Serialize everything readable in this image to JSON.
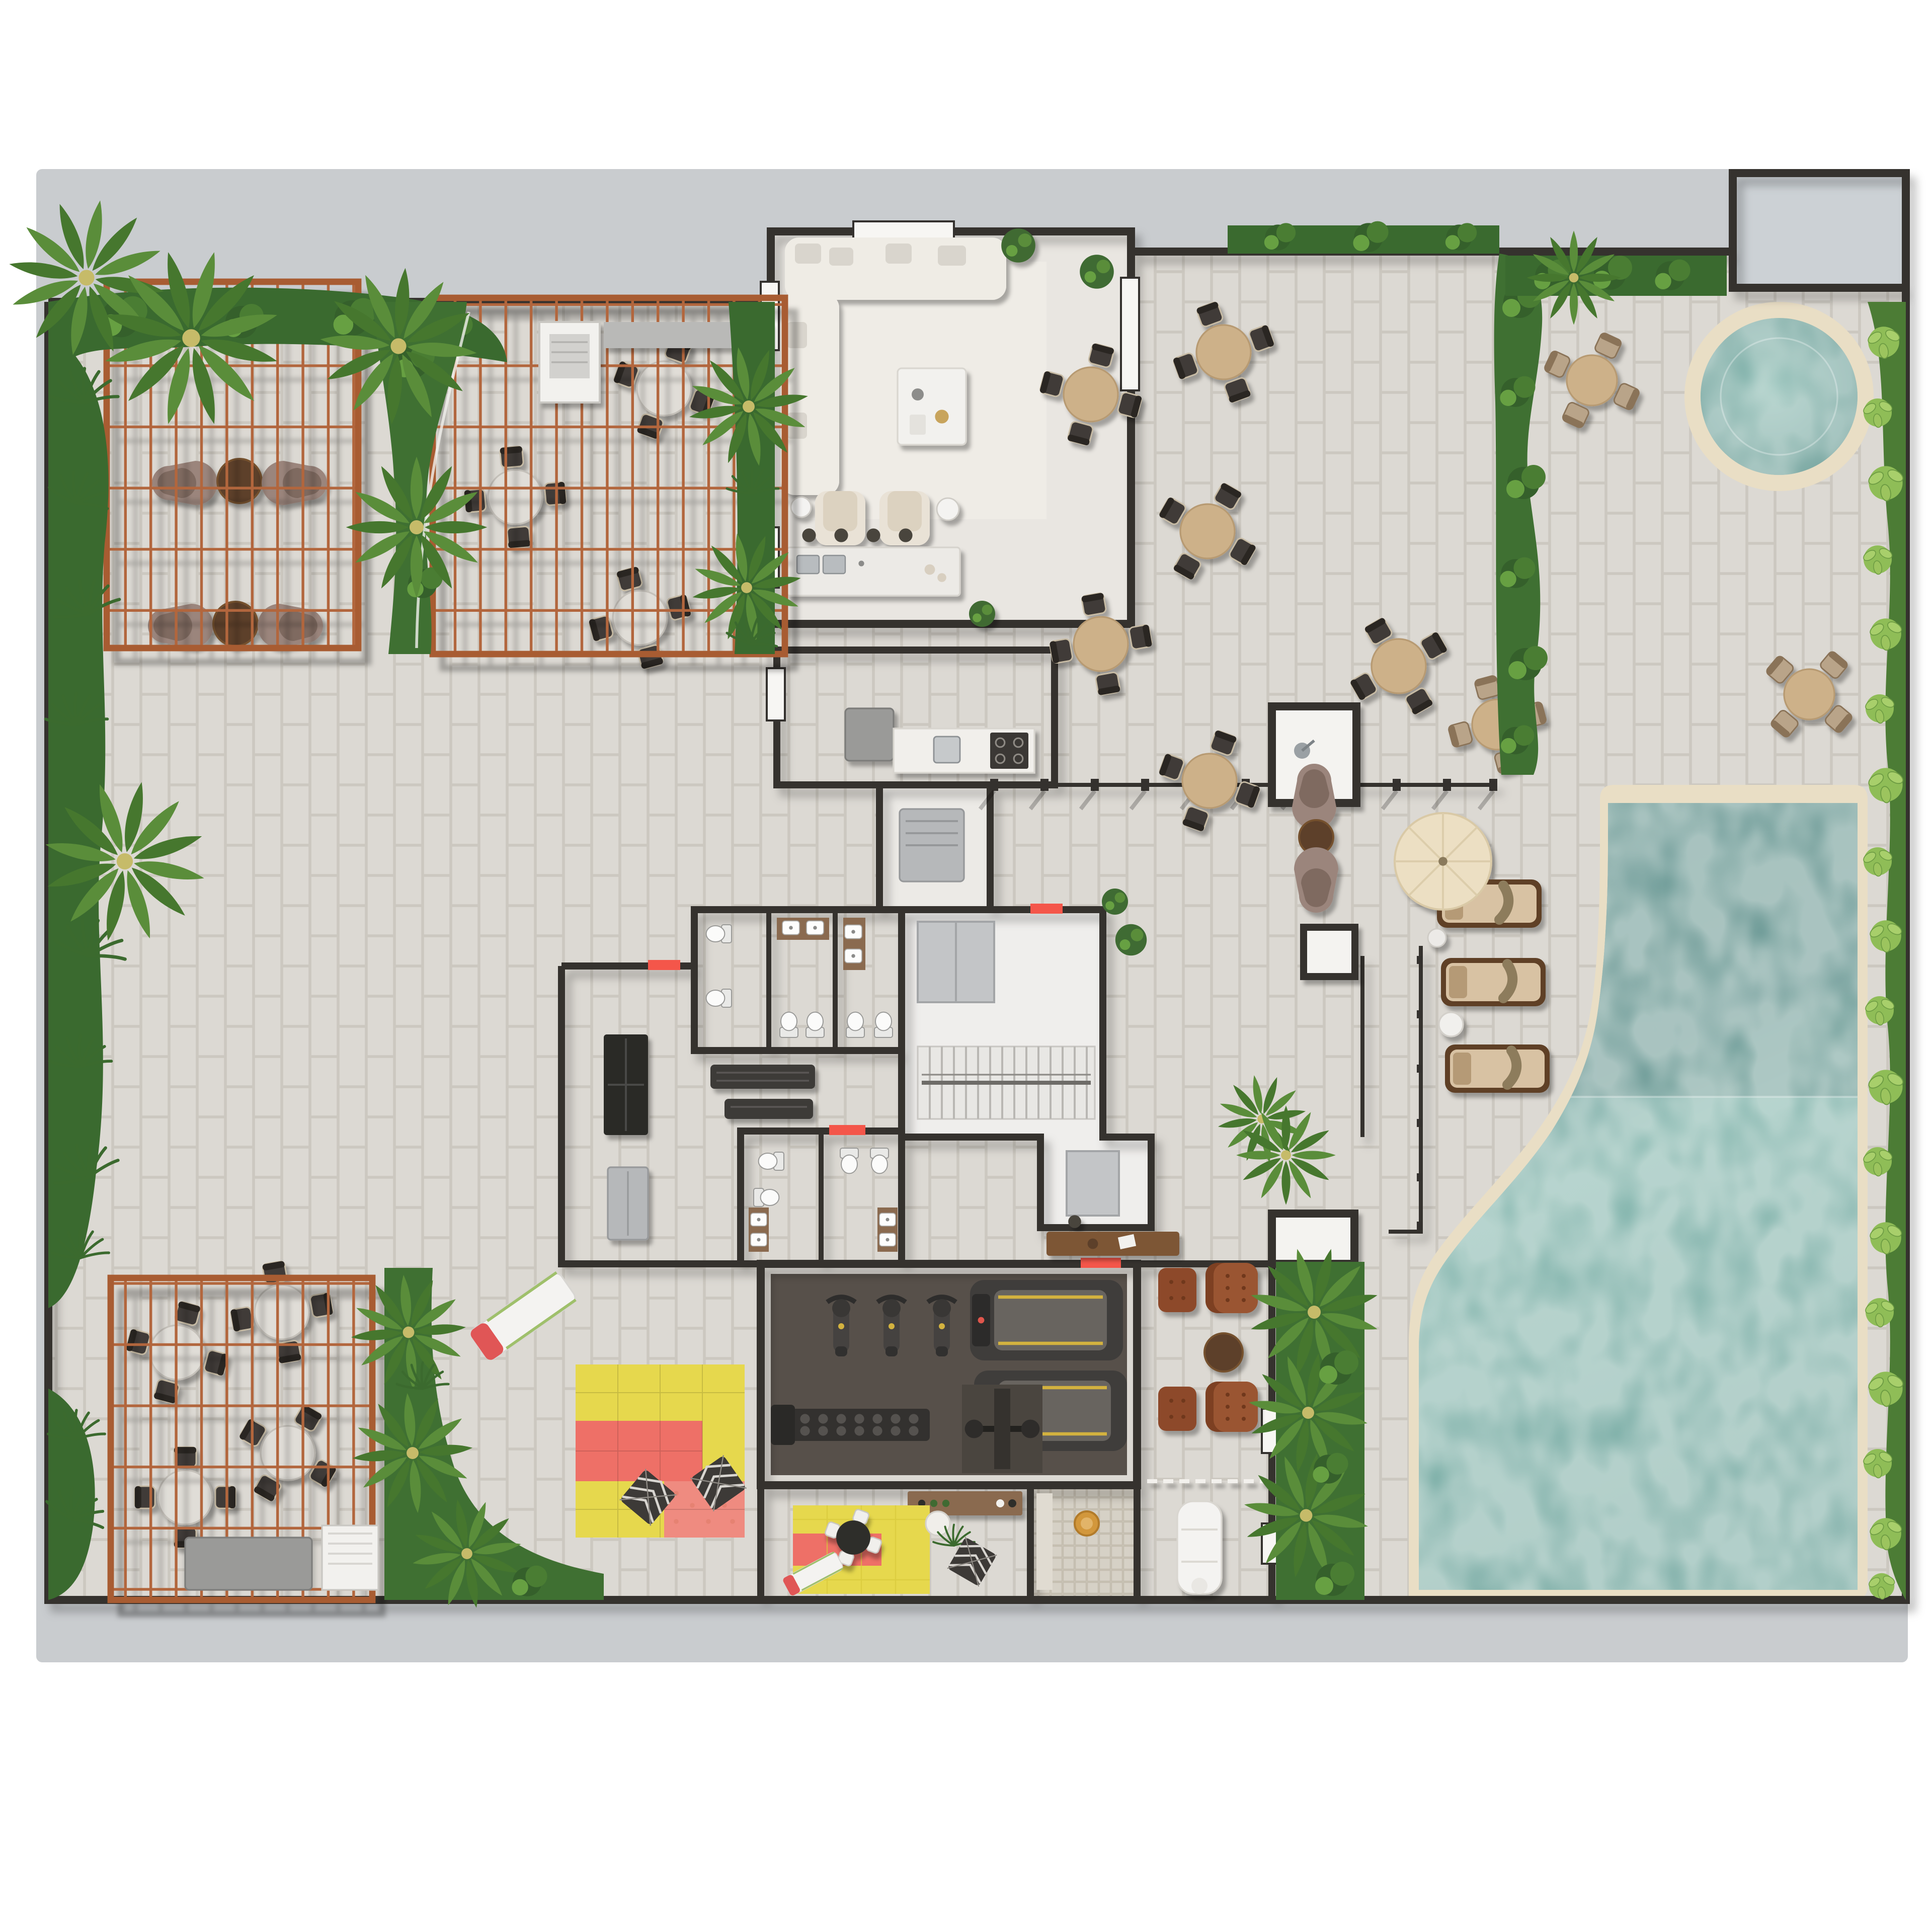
{
  "document": {
    "type": "architectural-floor-plan-render",
    "view": "top-down 3d render",
    "subject": "resort amenity deck floor plan with pools, pergolas, gym, spa and kids club",
    "visible_text": []
  },
  "palette": {
    "page_bg": "#ffffff",
    "slab": "#c9cccf",
    "void_room": "#ccd1d5",
    "paving": "#dcd9d3",
    "paving_line": "#ccc8c0",
    "room_floor": "#e9e6e1",
    "wall": "#34312e",
    "wall_cap": "#f3f1ed",
    "pergola_wood": "#b2663c",
    "green_dark": "#35602b",
    "green_mid": "#4a7d33",
    "green_light": "#67a042",
    "leaf_light": "#9cc45e",
    "pool_water": "#6fa39e",
    "pool_water_deep": "#527f7e",
    "pool_coping": "#e9dec5",
    "wood_table": "#cdb189",
    "stone_table": "#e0ddd7",
    "walnut": "#5d3f29",
    "chair_dark": "#3f3b37",
    "chair_tan": "#b9a489",
    "sofa_cream": "#efece5",
    "cushion_tan": "#d8c2a3",
    "umbrella": "#ecdfc3",
    "gym_floor": "#5a524a",
    "equipment": "#464442",
    "accent_yellow": "#d3b23f",
    "leather": "#8d4a2b",
    "red_accent": "#f4564a",
    "kids_yellow": "#e6d84d",
    "kids_pink": "#ee7067",
    "locker_black": "#2b2927",
    "cabinet_gray": "#b6b8ba",
    "steel": "#b8bcbf",
    "mosaic": "#d6d1c6",
    "gold": "#d2973c"
  },
  "areas": {
    "pergola_nw": {
      "label": "northwest pergola lounge"
    },
    "pergola_ne": {
      "label": "north pergola dining"
    },
    "pergola_sw": {
      "label": "southwest pergola dining"
    },
    "lounge_indoor": {
      "label": "indoor lounge with kitchen island"
    },
    "bbq_room": {
      "label": "bbq / prep kitchen"
    },
    "dining_terrace": {
      "label": "outdoor dining terrace"
    },
    "pool_deck": {
      "label": "pool deck with hot tub"
    },
    "hot_tub": {
      "label": "round hot tub"
    },
    "main_pool": {
      "label": "main swimming pool"
    },
    "sun_loungers": {
      "label": "sun loungers with umbrella"
    },
    "core": {
      "label": "restrooms, lockers, stairs and elevator core"
    },
    "reception": {
      "label": "reception desk"
    },
    "gym": {
      "label": "fitness room"
    },
    "kids_club": {
      "label": "kids club playroom"
    },
    "kids_playground": {
      "label": "outdoor kids play mats"
    },
    "sauna": {
      "label": "sauna / bath corridor"
    },
    "massage": {
      "label": "massage room"
    },
    "leather_lounge": {
      "label": "leather armchair lounge"
    },
    "gardens": {
      "label": "perimeter tropical planting"
    }
  },
  "counts": {
    "dining_terrace_tables": 6,
    "pergola_ne_tables": 3,
    "pergola_sw_tables": 4,
    "pool_deck_tables": 3,
    "nw_lounge_groups": 2,
    "sun_loungers": 3,
    "umbrellas": 1,
    "hot_tubs": 1,
    "exercise_bikes": 3,
    "treadmills": 2,
    "leather_armchairs": 2,
    "ottomans": 2,
    "play_tents": 2,
    "slides": 2,
    "massage_tables": 1
  }
}
